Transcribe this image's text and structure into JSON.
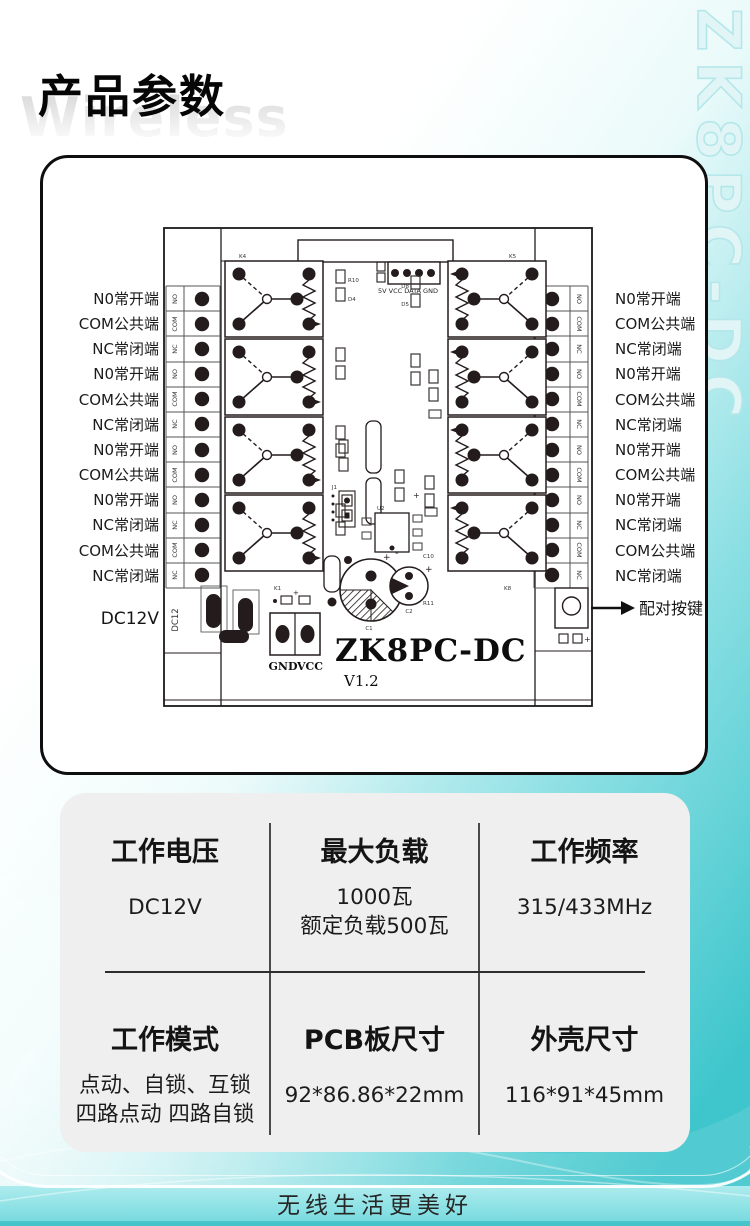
{
  "page": {
    "title": "产品参数",
    "watermark": "Wireless",
    "brand_vertical": "ZK8PC-DC",
    "footer_slogan": "无线生活更美好"
  },
  "colors": {
    "accent_teal": "#3ec6cc",
    "footer_band": "#8ae2e5",
    "card_gray": "#efefef",
    "ink": "#0e0e0e",
    "brand_outline": "#b4e7ea"
  },
  "pcb": {
    "left_labels": [
      "N0常开端",
      "COM公共端",
      "NC常闭端",
      "N0常开端",
      "COM公共端",
      "NC常闭端",
      "N0常开端",
      "COM公共端",
      "N0常开端",
      "NC常闭端",
      "COM公共端",
      "NC常闭端"
    ],
    "right_labels": [
      "N0常开端",
      "COM公共端",
      "NC常闭端",
      "N0常开端",
      "COM公共端",
      "NC常闭端",
      "N0常开端",
      "COM公共端",
      "N0常开端",
      "NC常闭端",
      "COM公共端",
      "NC常闭端"
    ],
    "terminal_tags": [
      "NO",
      "COM",
      "NC",
      "NO",
      "COM",
      "NC",
      "NO",
      "COM",
      "NO",
      "NC",
      "COM",
      "NC"
    ],
    "dc_label": "DC12V",
    "dc_strip_tag": "DC12",
    "pair_button_label": "配对按键",
    "connector_pins": "5V VCC DATA GND",
    "gnd": "GND",
    "vcc": "VCC",
    "board_name": "ZK8PC-DC",
    "board_version": "V1.2",
    "component_labels": {
      "k1": "K1",
      "k4": "K4",
      "k5": "K5",
      "k8": "K8",
      "j1": "J1",
      "u2": "U2",
      "r10": "R10",
      "d4": "D4",
      "d8": "D8",
      "d5": "D5",
      "c1": "C1",
      "c2": "C2",
      "c10": "C10",
      "r11": "R11"
    }
  },
  "specs": {
    "cells": [
      {
        "title": "工作电压",
        "lines": [
          "DC12V"
        ]
      },
      {
        "title": "最大负载",
        "lines": [
          "1000瓦",
          "额定负载500瓦"
        ]
      },
      {
        "title": "工作频率",
        "lines": [
          "315/433MHz"
        ]
      },
      {
        "title": "工作模式",
        "lines": [
          "点动、自锁、互锁",
          "四路点动 四路自锁"
        ]
      },
      {
        "title": "PCB板尺寸",
        "lines": [
          "92*86.86*22mm"
        ]
      },
      {
        "title": "外壳尺寸",
        "lines": [
          "116*91*45mm"
        ]
      }
    ]
  }
}
